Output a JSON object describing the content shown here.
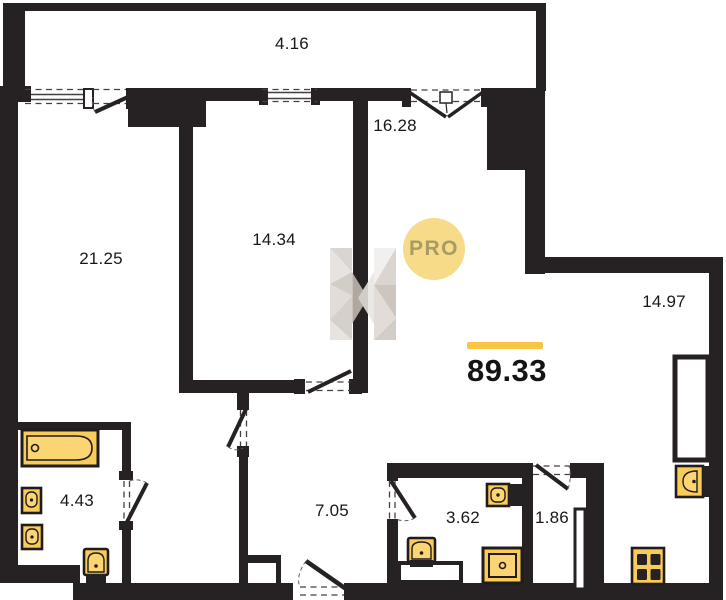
{
  "plan": {
    "title": "apartment-floor-plan",
    "total_area": "89.33",
    "watermark_badge": "PRO",
    "rooms": [
      {
        "name": "balcony",
        "label": "4.16",
        "cx": 292,
        "cy": 44
      },
      {
        "name": "living-room",
        "label": "21.25",
        "cx": 101,
        "cy": 259
      },
      {
        "name": "bedroom",
        "label": "14.34",
        "cx": 274,
        "cy": 240
      },
      {
        "name": "room-16",
        "label": "16.28",
        "cx": 395,
        "cy": 126
      },
      {
        "name": "kitchen",
        "label": "14.97",
        "cx": 664,
        "cy": 302
      },
      {
        "name": "bathroom",
        "label": "4.43",
        "cx": 77,
        "cy": 501
      },
      {
        "name": "hallway",
        "label": "7.05",
        "cx": 332,
        "cy": 511
      },
      {
        "name": "wc",
        "label": "3.62",
        "cx": 463,
        "cy": 518
      },
      {
        "name": "storage",
        "label": "1.86",
        "cx": 552,
        "cy": 518
      }
    ],
    "colors": {
      "wall": "#262223",
      "fixture_fill": "#F9CB58",
      "fixture_fill_light": "#FBD573",
      "fixture_stroke": "#201C1D",
      "accent_bar": "#F5C543",
      "pro_circle": "#F8DB88",
      "pro_text": "#A89C64",
      "label_text": "#1B1718"
    }
  }
}
